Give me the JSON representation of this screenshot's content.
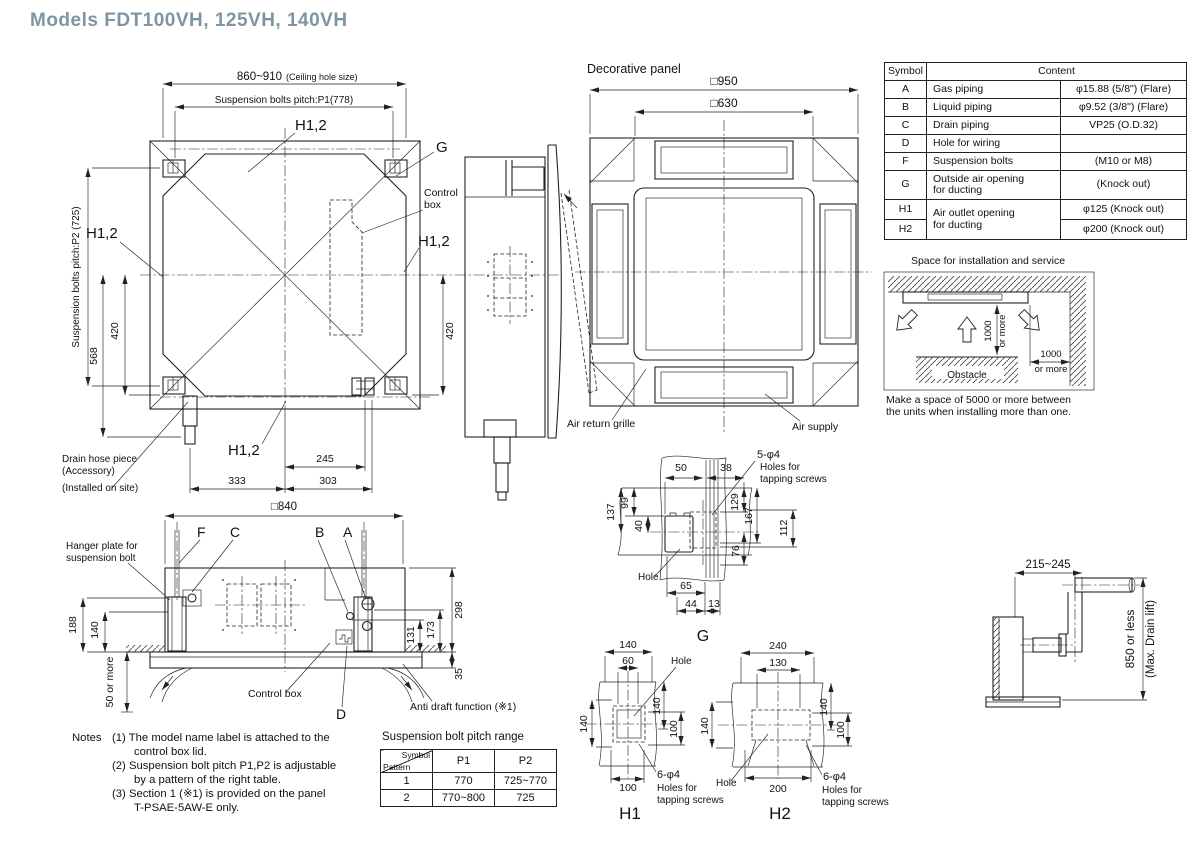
{
  "title": "Models  FDT100VH, 125VH, 140VH",
  "colors": {
    "title": "#7e95a3",
    "line": "#222222"
  },
  "plan": {
    "ceiling": "860~910",
    "ceiling_note": "(Ceiling hole size)",
    "p1": "Suspension bolts pitch:P1(778)",
    "p2": "Suspension bolts pitch:P2 (725)",
    "h12": "H1,2",
    "g": "G",
    "control1": "Control",
    "control2": "box",
    "d420": "420",
    "d568": "568",
    "d245": "245",
    "d333": "333",
    "d303": "303",
    "drain1": "Drain hose piece",
    "drain2": "(Accessory)",
    "drain3": "(Installed on site)"
  },
  "front": {
    "decorative_panel": "Decorative panel",
    "d950": "□950",
    "d630": "□630",
    "air_return": "Air return grille",
    "air_supply": "Air supply"
  },
  "symbol_table": {
    "header_symbol": "Symbol",
    "header_content": "Content",
    "rows": {
      "a": {
        "s": "A",
        "n": "Gas piping",
        "v": "φ15.88 (5/8\") (Flare)"
      },
      "b": {
        "s": "B",
        "n": "Liquid piping",
        "v": "φ9.52 (3/8\") (Flare)"
      },
      "c": {
        "s": "C",
        "n": "Drain piping",
        "v": "VP25 (O.D.32)"
      },
      "d": {
        "s": "D",
        "n": "Hole for wiring",
        "v": ""
      },
      "f": {
        "s": "F",
        "n": "Suspension bolts",
        "v": "(M10 or M8)"
      },
      "g": {
        "s": "G",
        "n1": "Outside air opening",
        "n2": "for ducting",
        "v": "(Knock out)"
      },
      "h1": {
        "s": "H1",
        "n1": "Air outlet opening",
        "n2": "for ducting",
        "v": "φ125 (Knock out)"
      },
      "h2": {
        "s": "H2",
        "v": "φ200 (Knock out)"
      }
    }
  },
  "space": {
    "title": "Space for installation and service",
    "v1000": "1000",
    "v_more": "or more",
    "obstacle": "Obstacle",
    "h1000": "1000",
    "h_more": "or more",
    "note1": "Make a space of 5000 or more between",
    "note2": "the units when installing more than one."
  },
  "section": {
    "d840": "□840",
    "f": "F",
    "c": "C",
    "b": "B",
    "a": "A",
    "d": "D",
    "hanger1": "Hanger plate for",
    "hanger2": "suspension bolt",
    "d188": "188",
    "d140": "140",
    "d50": "50 or more",
    "d298": "298",
    "d173": "173",
    "d131": "131",
    "d35": "35",
    "control_box": "Control box",
    "anti_draft": "Anti draft function (※1)"
  },
  "notes": {
    "heading": "Notes",
    "n1a": "(1) The model name label is attached to the",
    "n1b": "control box lid.",
    "n2a": "(2) Suspension bolt pitch P1,P2 is adjustable",
    "n2b": "by a pattern of the right table.",
    "n3a": "(3) Section 1 (※1) is provided on the panel",
    "n3b": "T-PSAE-5AW-E only."
  },
  "pitch": {
    "title": "Suspension bolt pitch range",
    "symbol": "Symbol",
    "pattern": "Pattern",
    "p1": "P1",
    "p2": "P2",
    "r1p": "1",
    "r1a": "770",
    "r1b": "725~770",
    "r2p": "2",
    "r2a": "770~800",
    "r2b": "725"
  },
  "gdet": {
    "phi": "5-φ4",
    "holes1": "Holes for",
    "holes2": "tapping  screws",
    "d50": "50",
    "d38": "38",
    "d99": "99",
    "d137": "137",
    "d40": "40",
    "d129": "129",
    "d167": "167",
    "d112": "112",
    "d76": "76",
    "hole": "Hole",
    "d65": "65",
    "d44": "44",
    "d13": "13",
    "label": "G"
  },
  "h1det": {
    "d140t": "140",
    "d60": "60",
    "hole": "Hole",
    "d140l": "140",
    "d140r": "140",
    "d100r": "100",
    "d100b": "100",
    "phi": "6-φ4",
    "holes1": "Holes for",
    "holes2": "tapping screws",
    "label": "H1"
  },
  "h2det": {
    "d240": "240",
    "d130": "130",
    "hole": "Hole",
    "d140l": "140",
    "d140r": "140",
    "d100r": "100",
    "d200": "200",
    "phi": "6-φ4",
    "holes1": "Holes for",
    "holes2": "tapping screws",
    "label": "H2"
  },
  "drain": {
    "d215": "215~245",
    "d850": "850 or less",
    "d850b": "(Max. Drain lift)"
  }
}
